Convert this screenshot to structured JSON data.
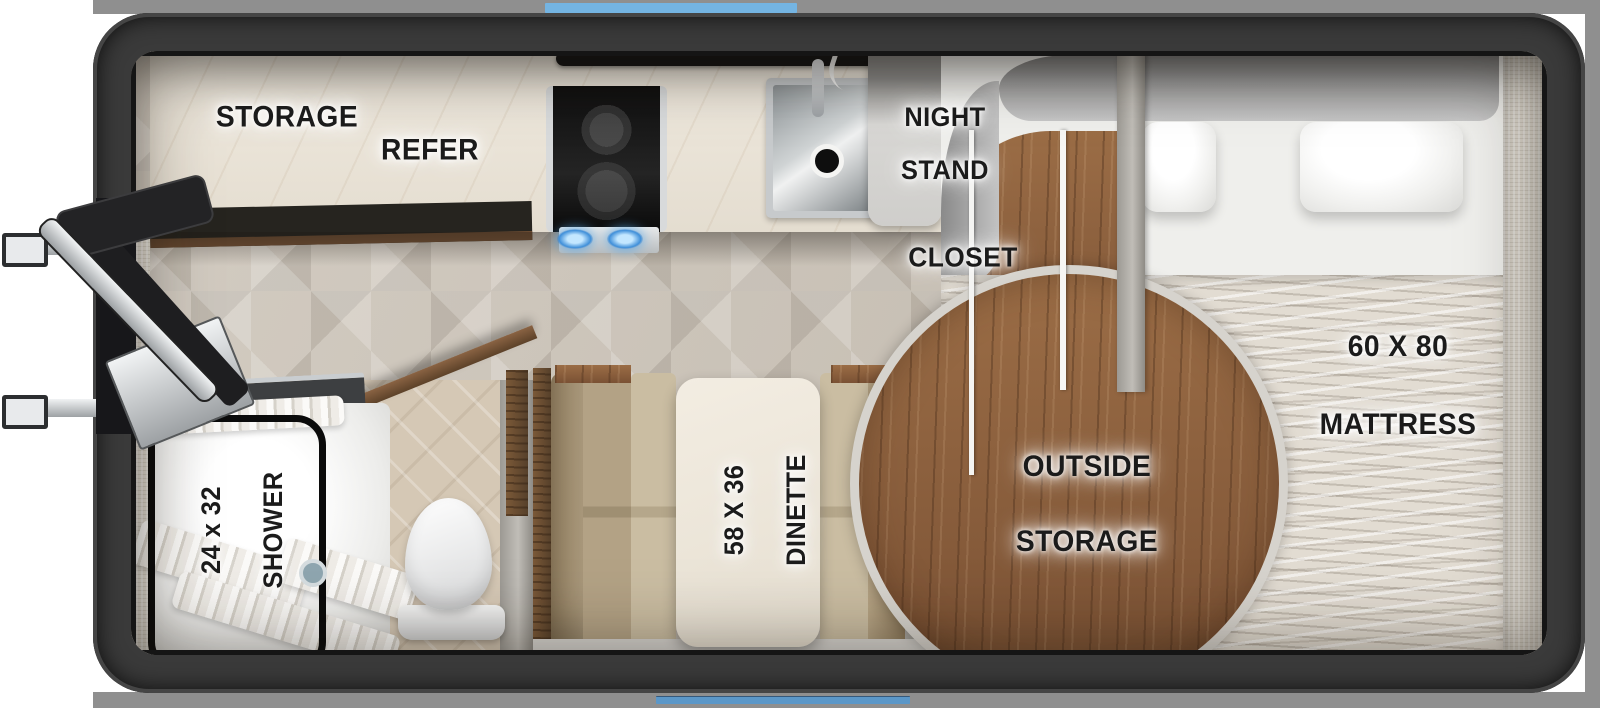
{
  "floorplan": {
    "labels": {
      "storage": "STORAGE",
      "refer": "REFER",
      "night_stand_line1": "NIGHT",
      "night_stand_line2": "STAND",
      "closet": "CLOSET",
      "mattress_line1": "60 X 80",
      "mattress_line2": "MATTRESS",
      "outside_storage_line1": "OUTSIDE",
      "outside_storage_line2": "STORAGE",
      "shower_line1": "24 x 32",
      "shower_line2": "SHOWER",
      "dinette_line1": "58 X 36",
      "dinette_line2": "DINETTE"
    },
    "colors": {
      "accent_blue_top": "#74b4e2",
      "accent_blue_bottom": "#5b97c8",
      "frame_dark": "#3a3a3a",
      "outer_band_gray": "#8f8f8f",
      "wood_brown": "#8a5e3c",
      "floor_taupe": "#c8c1b6",
      "counter_marble": "#ebe5da",
      "cushion_tan": "#c0b193",
      "label_text": "#1b1b1b"
    }
  }
}
